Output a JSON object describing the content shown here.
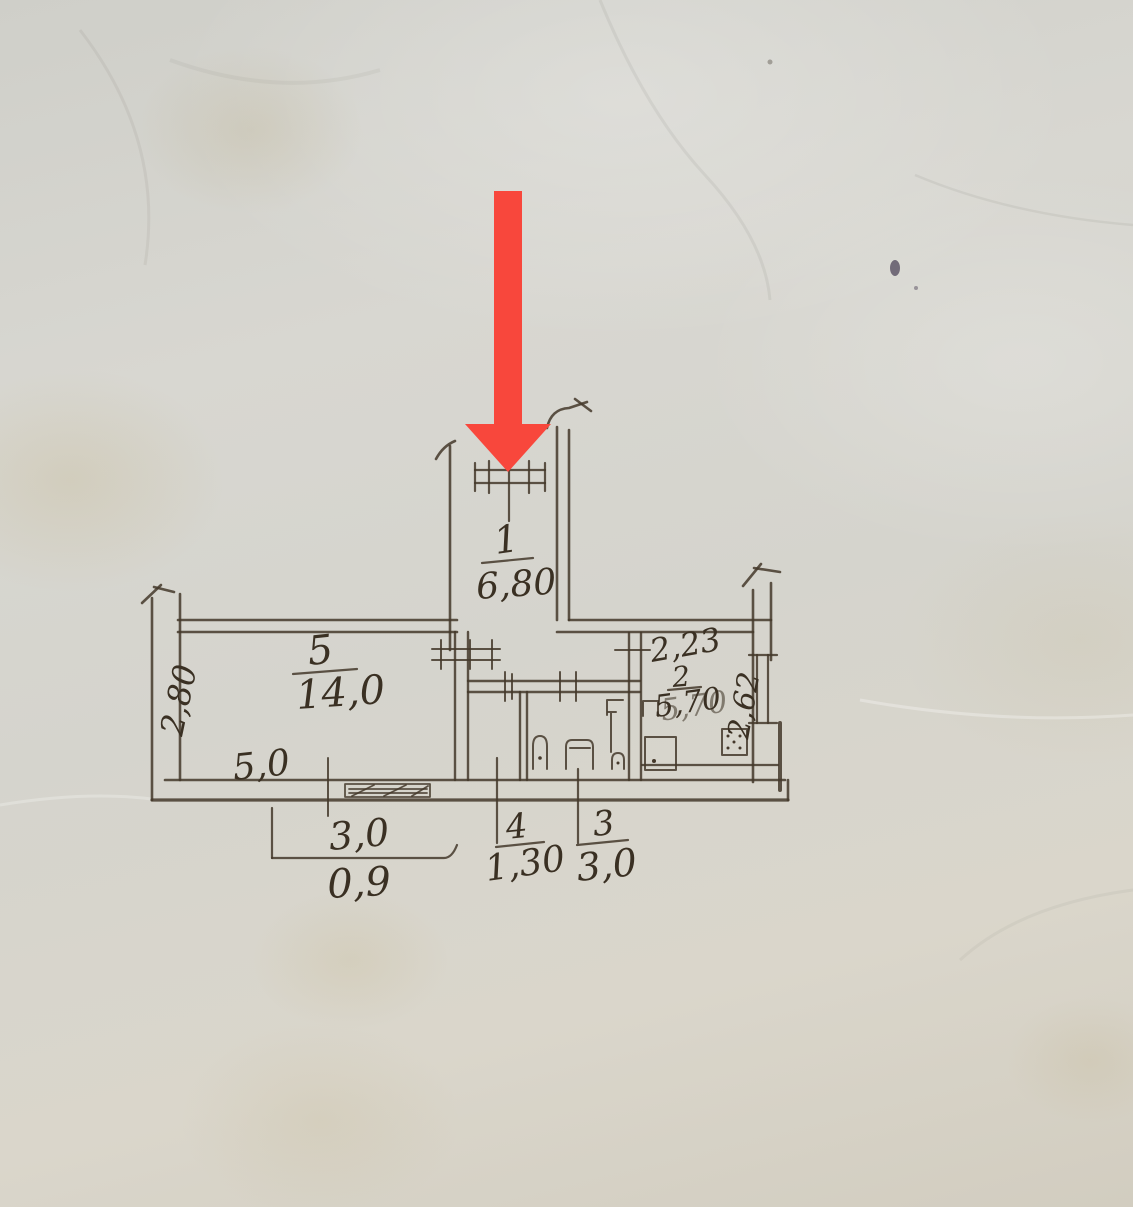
{
  "drawing": {
    "kind": "hand-drawn apartment floor plan",
    "colors": {
      "paper": "#d6d5cf",
      "ink": "#3a3023",
      "arrow_red": "#f8473c"
    }
  },
  "rooms": [
    {
      "number": "1",
      "area": "6,80"
    },
    {
      "number": "5",
      "area": "14,0"
    },
    {
      "number": "2",
      "area": "5,70"
    },
    {
      "number": "4",
      "area": "1,30"
    },
    {
      "number": "3",
      "area": "3,0"
    }
  ],
  "dimensions": {
    "room5_depth": "2,80",
    "room5_width": "5,0",
    "bottom_window_width": "3,0",
    "bottom_offset": "0,9",
    "room2_width": "2,23",
    "room2_depth": "2,62"
  }
}
